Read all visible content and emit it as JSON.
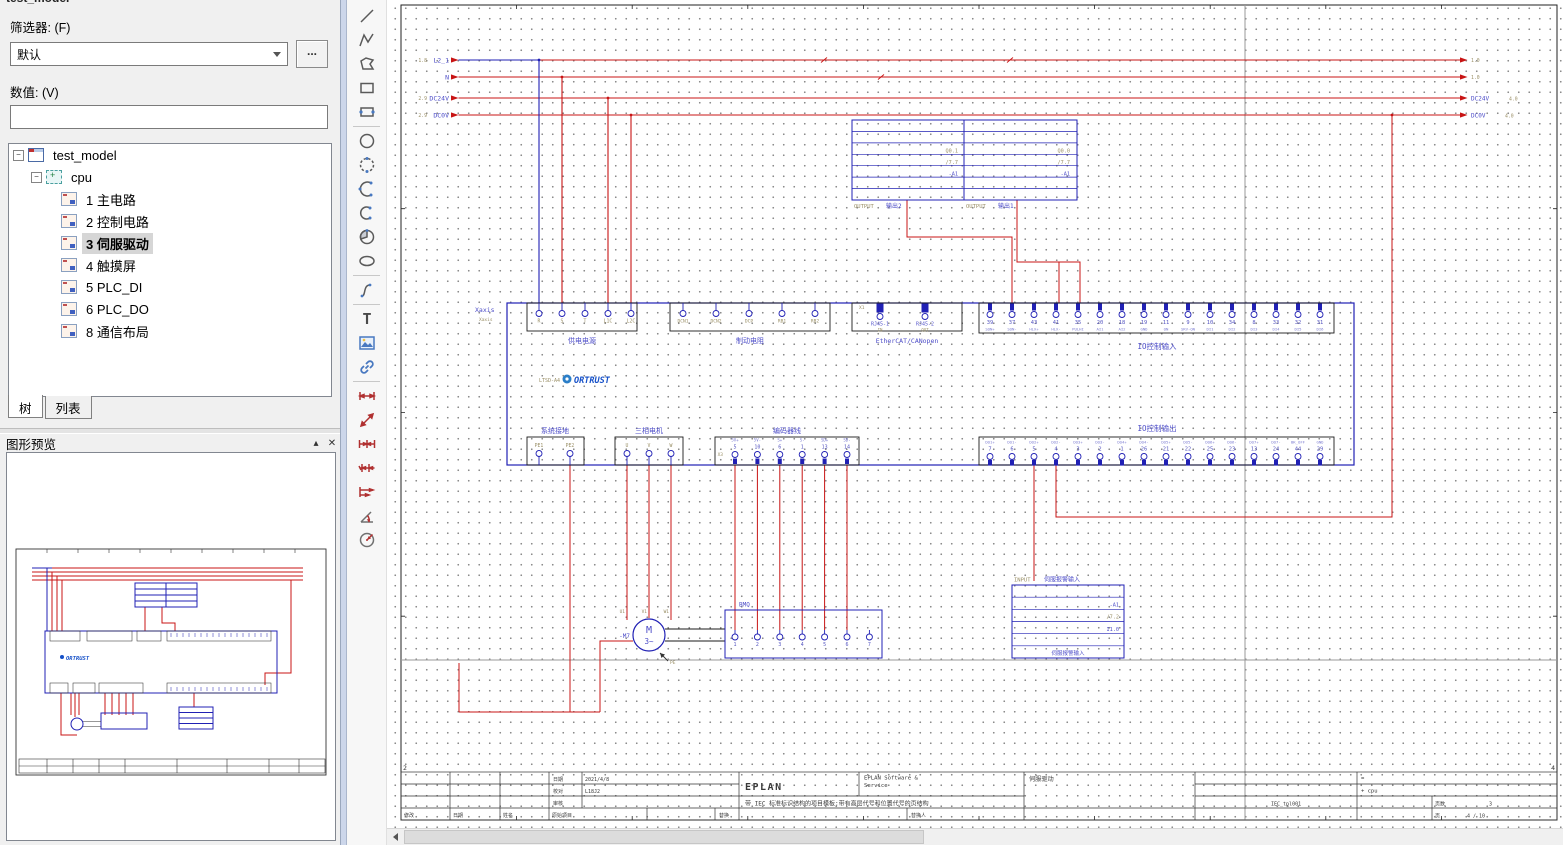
{
  "panel": {
    "top_fragment": "test_model",
    "filter_label": "筛选器: (F)",
    "filter_value": "默认",
    "more_button": "...",
    "value_label": "数值: (V)",
    "value_text": "",
    "tabs": {
      "tree": "树",
      "list": "列表"
    },
    "preview_title": "图形预览",
    "icons": {
      "collapse": "▴",
      "close": "✕"
    }
  },
  "tree": {
    "root": "test_model",
    "group": "cpu",
    "pages": [
      {
        "label": "1 主电路",
        "selected": false
      },
      {
        "label": "2 控制电路",
        "selected": false
      },
      {
        "label": "3 伺服驱动",
        "selected": true
      },
      {
        "label": "4 触摸屏",
        "selected": false
      },
      {
        "label": "5 PLC_DI",
        "selected": false
      },
      {
        "label": "6 PLC_DO",
        "selected": false
      },
      {
        "label": "8 通信布局",
        "selected": false
      }
    ]
  },
  "toolbar": {
    "groups": [
      [
        "line",
        "polyline",
        "polygon",
        "rectangle",
        "rectangle-2point"
      ],
      [
        "circle",
        "circle-2point",
        "arc-3point",
        "arc-2point",
        "sector",
        "ellipse"
      ],
      [
        "spline"
      ],
      [
        "text",
        "image",
        "hyperlink"
      ],
      [
        "dim-linear",
        "dim-aligned",
        "dim-chain",
        "dim-chain-2",
        "dim-baseline",
        "dim-angle",
        "dim-radius"
      ]
    ]
  },
  "schematic": {
    "bus": {
      "rows": [
        {
          "label": "L2_1",
          "left_ref": "1.8",
          "right_ref": "1.0",
          "right_label": ""
        },
        {
          "label": "N",
          "left_ref": "",
          "right_ref": "1.0",
          "right_label": ""
        },
        {
          "label": "DC24V",
          "left_ref": "2.9",
          "right_ref": "4.0",
          "right_label": "DC24V"
        },
        {
          "label": "DC0V",
          "left_ref": "2.9",
          "right_ref": "4.0",
          "right_label": "DC0V"
        }
      ]
    },
    "device": {
      "tag": "Xaxis",
      "tag2": "Xaxis",
      "model": "LTSD-A4",
      "brand": "ORTRUST"
    },
    "power": {
      "label": "供电电源",
      "names": [
        "R",
        "S",
        "T",
        "L1C",
        "L2C"
      ]
    },
    "brake": {
      "label": "制动电阻",
      "names": [
        "DCN1",
        "DCN2",
        "DCP",
        "RB1",
        "RB2"
      ]
    },
    "ethercat": {
      "label": "EtherCAT/CANopen",
      "connector": "X1",
      "names": [
        "RJ45-1",
        "RJ45-2"
      ],
      "subs": [
        "IN",
        "OUT"
      ]
    },
    "io_in": {
      "label": "IO控制输入",
      "numbers": [
        "39",
        "37",
        "43",
        "41",
        "35",
        "20",
        "18",
        "19",
        "11",
        "9",
        "10",
        "34",
        "8",
        "33",
        "32",
        "31"
      ],
      "names": [
        "SON+",
        "SON-",
        "HLX+",
        "HLX-",
        "PULHI",
        "AI1",
        "AI2",
        "GND",
        "ON",
        "SRV-ON",
        "DI1",
        "DI2",
        "DI3",
        "DI4",
        "DI5",
        "DI6"
      ]
    },
    "ground": {
      "label": "系统接地",
      "names": [
        "PE1",
        "PE2"
      ]
    },
    "motor3": {
      "label": "三相电机",
      "names": [
        "U",
        "V",
        "W"
      ]
    },
    "encoder": {
      "label": "编码器线",
      "connector": "X3",
      "numbers": [
        "5",
        "10",
        "6",
        "1",
        "13",
        "14"
      ],
      "names": [
        "5V+",
        "5V-",
        "S+",
        "S-",
        "SD+",
        "SD-"
      ]
    },
    "io_out": {
      "label": "IO控制输出",
      "numbers": [
        "7",
        "6",
        "5",
        "4",
        "3",
        "2",
        "1",
        "26",
        "21",
        "22",
        "25",
        "23",
        "13",
        "24",
        "44",
        "29"
      ],
      "names": [
        "DO1+",
        "DO1-",
        "DO2+",
        "DO2-",
        "DO3+",
        "DO3-",
        "DO4+",
        "DO4-",
        "DO5+",
        "DO5-",
        "DO6+",
        "DO6-",
        "DO7+",
        "DO7-",
        "BK_OFF",
        "GND"
      ]
    },
    "motor": {
      "tag": "-M7",
      "letter": "M",
      "phase": "3~",
      "pins": [
        "U1",
        "V1",
        "W1"
      ],
      "pe": "PE"
    },
    "bmq": {
      "label": "BMQ",
      "numbers": [
        "1",
        "2",
        "3",
        "4",
        "5",
        "6",
        "7"
      ]
    },
    "plc_out2": {
      "type": "OUTPUT",
      "name": "输出2",
      "rows": [
        "Q0.1",
        "/7.7",
        "-A1"
      ]
    },
    "plc_out1": {
      "type": "OUTPUT",
      "name": "输出1",
      "rows": [
        "Q0.0",
        "/7.7",
        "-A1"
      ]
    },
    "plc_in": {
      "type": "INPUT",
      "name": "伺服报警输入",
      "rows": [
        "-A1",
        "/7.2",
        "I1.0"
      ],
      "bottom": "伺服报警输入"
    },
    "frame": {
      "left_marker": "2",
      "right_marker": "4"
    },
    "title_block": {
      "date_label": "日期",
      "date": "2021/4/8",
      "check_label": "校对",
      "check": "L18J2",
      "audit_label": "审核",
      "modify_label": "修改",
      "date2_label": "日期",
      "name_label": "姓名",
      "orig_label": "原始项目",
      "replace_label": "替换",
      "replace_by_label": "替换人",
      "brand": "EPLAN",
      "desc": "带 IEC 标准标识结构的项目模板:带有高层代号和位置代号的页结构",
      "company1": "EPLAN Software &",
      "company2": "Service",
      "page_title": "伺服驱动",
      "eq": "=",
      "structure": "+ cpu",
      "form": "IEC_tpl001",
      "pages_label": "页数",
      "pages_value": "3",
      "page_label": "页",
      "page_value": "4 / 10"
    }
  },
  "colors": {
    "wire": "#c81414",
    "symbol": "#2020b4",
    "ref": "#9a8f66",
    "label": "#4d4dc8"
  }
}
